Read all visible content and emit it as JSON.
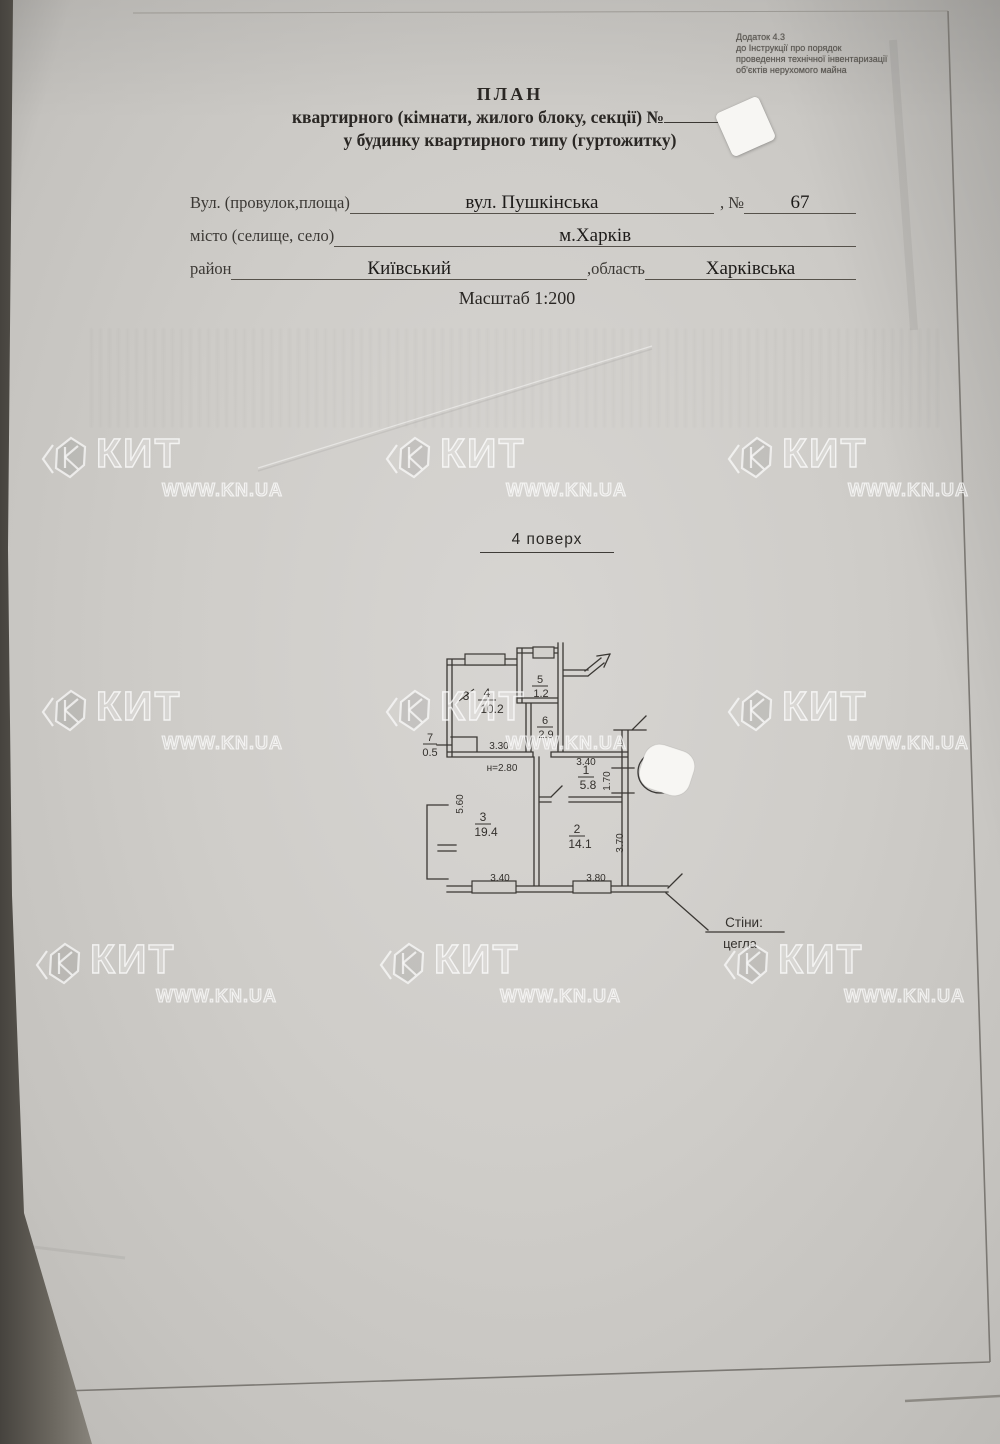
{
  "appendix": {
    "lines": [
      "Додаток 4.3",
      "до Інструкції про порядок",
      "проведення технічної інвентаризації",
      "об'єктів нерухомого майна"
    ]
  },
  "title": {
    "heading": "ПЛАН",
    "line2": "квартирного (кімнати, жилого блоку, секції) №",
    "line3": "у будинку квартирного типу (гуртожитку)"
  },
  "address": {
    "street_label": "Вул. (провулок,площа)",
    "street_value": "вул. Пушкінська",
    "number_label": ", №",
    "number_value": "67",
    "city_label": "місто (селище, село)",
    "city_value": "м.Харків",
    "district_label": "район",
    "district_value": "Київський",
    "region_label": ",область",
    "region_value": "Харківська"
  },
  "scale": {
    "label": "Масштаб 1:200"
  },
  "floor": {
    "label": "4 поверх"
  },
  "watermark": {
    "brand": "КИТ",
    "site": "WWW.KN.UA"
  },
  "plan": {
    "height_note": "н=2.80",
    "walls_note_label": "Стіни:",
    "walls_note_value": "цегла",
    "rooms": {
      "r1": {
        "num": "1",
        "area": "5.8"
      },
      "r2": {
        "num": "2",
        "area": "14.1"
      },
      "r3": {
        "num": "3",
        "area": "19.4"
      },
      "r4": {
        "num": "4",
        "area": "10.2",
        "old_num": "3"
      },
      "r5": {
        "num": "5",
        "area": "1.2"
      },
      "r6": {
        "num": "6",
        "area": "2.9"
      },
      "r7": {
        "num": "7",
        "area": "0.5"
      }
    },
    "dims": {
      "corridor": "3.30",
      "room1_top": "3.40",
      "room1_right": "1.70",
      "room3_left": "5.60",
      "room3_bottom": "3.40",
      "room2_bottom": "3.80",
      "room2_right": "3.70"
    }
  }
}
